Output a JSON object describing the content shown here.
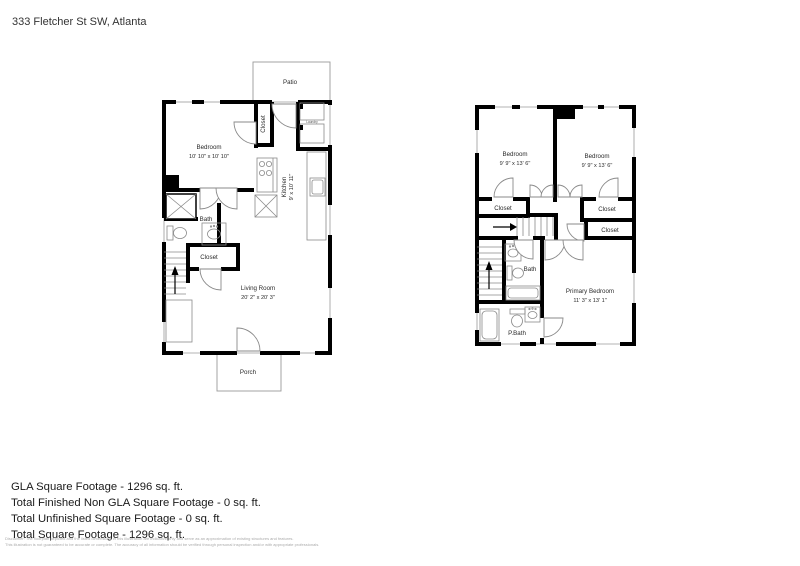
{
  "page": {
    "address": "333 Fletcher St SW, Atlanta"
  },
  "floor1": {
    "patio_label": "Patio",
    "porch_label": "Porch",
    "bedroom": {
      "name": "Bedroom",
      "dims": "10' 10\" x 10' 10\""
    },
    "closet_upper_label": "Closet",
    "kitchen": {
      "name": "Kitchen",
      "dims": "9' x 10' 11\""
    },
    "laundry_label": "Laundry",
    "bath_label": "Bath",
    "closet_lower_label": "Closet",
    "living_room": {
      "name": "Living Room",
      "dims": "20' 2\" x 20' 3\""
    }
  },
  "floor2": {
    "bedroom_left": {
      "name": "Bedroom",
      "dims": "9' 9\" x 13' 6\""
    },
    "bedroom_right": {
      "name": "Bedroom",
      "dims": "9' 9\" x 13' 6\""
    },
    "closet_left_label": "Closet",
    "closet_right_upper_label": "Closet",
    "closet_right_lower_label": "Closet",
    "bath_label": "Bath",
    "primary_bedroom": {
      "name": "Primary Bedroom",
      "dims": "11' 3\" x 13' 1\""
    },
    "pbath_label": "P.Bath"
  },
  "summary": {
    "line1": "GLA Square Footage - 1296 sq. ft.",
    "line2": "Total Finished Non GLA Square Footage - 0 sq. ft.",
    "line3": "Total Unfinished Square Footage - 0 sq. ft.",
    "line4": "Total Square Footage - 1296 sq. ft."
  },
  "disclaimer": {
    "line1": "Disclaimer: The floorplan depicted and the listed dimensions in this illustration are indicative only and serve as an approximation of existing structures and features.",
    "line2": "This illustration is not guaranteed to be accurate or complete. The accuracy of all information should be verified through personal inspection and/or with appropriate professionals."
  }
}
